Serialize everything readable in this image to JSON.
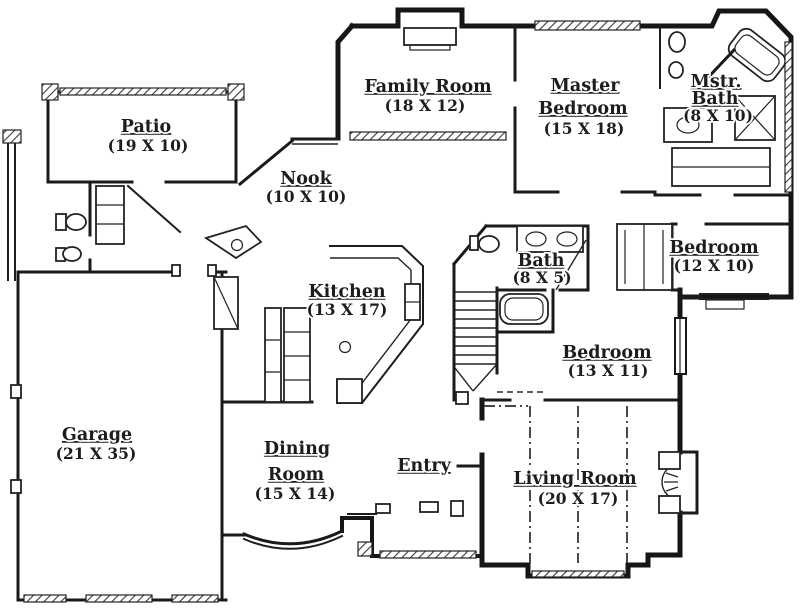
{
  "colors": {
    "ink": "#1a1a1a",
    "paper": "#ffffff"
  },
  "rooms": {
    "patio": {
      "name": "Patio",
      "dims": "(19 X 10)"
    },
    "family_room": {
      "name": "Family Room",
      "dims": "(18 X 12)"
    },
    "master_bedroom": {
      "name1": "Master",
      "name2": "Bedroom",
      "dims": "(15 X 18)"
    },
    "master_bath": {
      "name1": "Mstr.",
      "name2": "Bath",
      "dims": "(8 X 10)"
    },
    "nook": {
      "name": "Nook",
      "dims": "(10 X 10)"
    },
    "kitchen": {
      "name": "Kitchen",
      "dims": "(13 X 17)"
    },
    "bath": {
      "name": "Bath",
      "dims": "(8 X 5)"
    },
    "bedroom_right": {
      "name": "Bedroom",
      "dims": "(12 X 10)"
    },
    "bedroom_center": {
      "name": "Bedroom",
      "dims": "(13 X 11)"
    },
    "garage": {
      "name": "Garage",
      "dims": "(21 X 35)"
    },
    "dining_room": {
      "name1": "Dining",
      "name2": "Room",
      "dims": "(15 X 14)"
    },
    "entry": {
      "name": "Entry"
    },
    "living_room": {
      "name": "Living Room",
      "dims": "(20 X 17)"
    }
  }
}
